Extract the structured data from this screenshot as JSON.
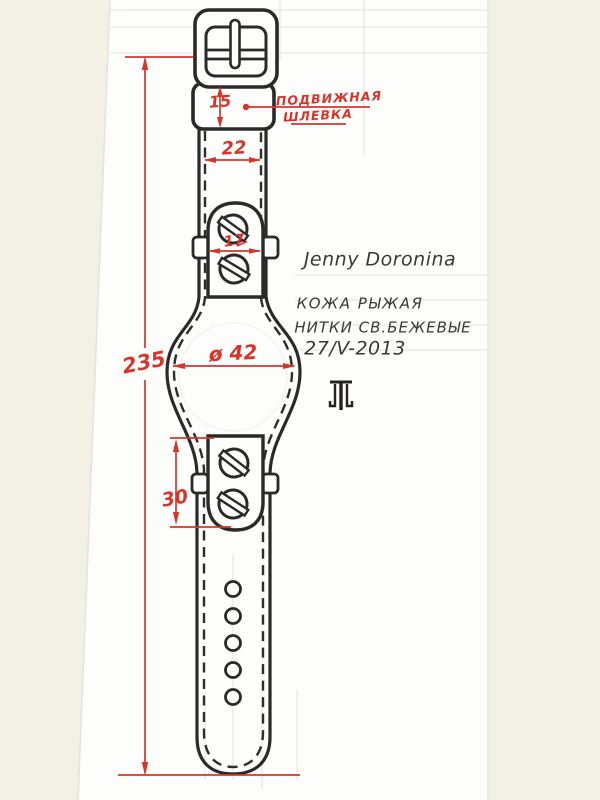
{
  "sheet": {
    "red_annotations": {
      "keeper_label": {
        "line1": "ПОДВИЖНАЯ",
        "line2": "ШЛЕВКА"
      },
      "dims": {
        "keeper_height": "15",
        "strap_width": "22",
        "lug_width": "17",
        "total_length": "235",
        "case_diameter": "ø 42",
        "lower_mount_height": "30"
      }
    },
    "pencil_notes": {
      "author": "Jenny Doronina",
      "material": "КОЖА РЫЖАЯ",
      "thread": "НИТКИ СВ.БЕЖЕВЫЕ",
      "date": "27/V-2013"
    },
    "colors": {
      "dimension_red": "#d8352a",
      "ink": "#2b2a28",
      "paper": "#fdfdfb",
      "margin": "#f3f1e6"
    }
  }
}
